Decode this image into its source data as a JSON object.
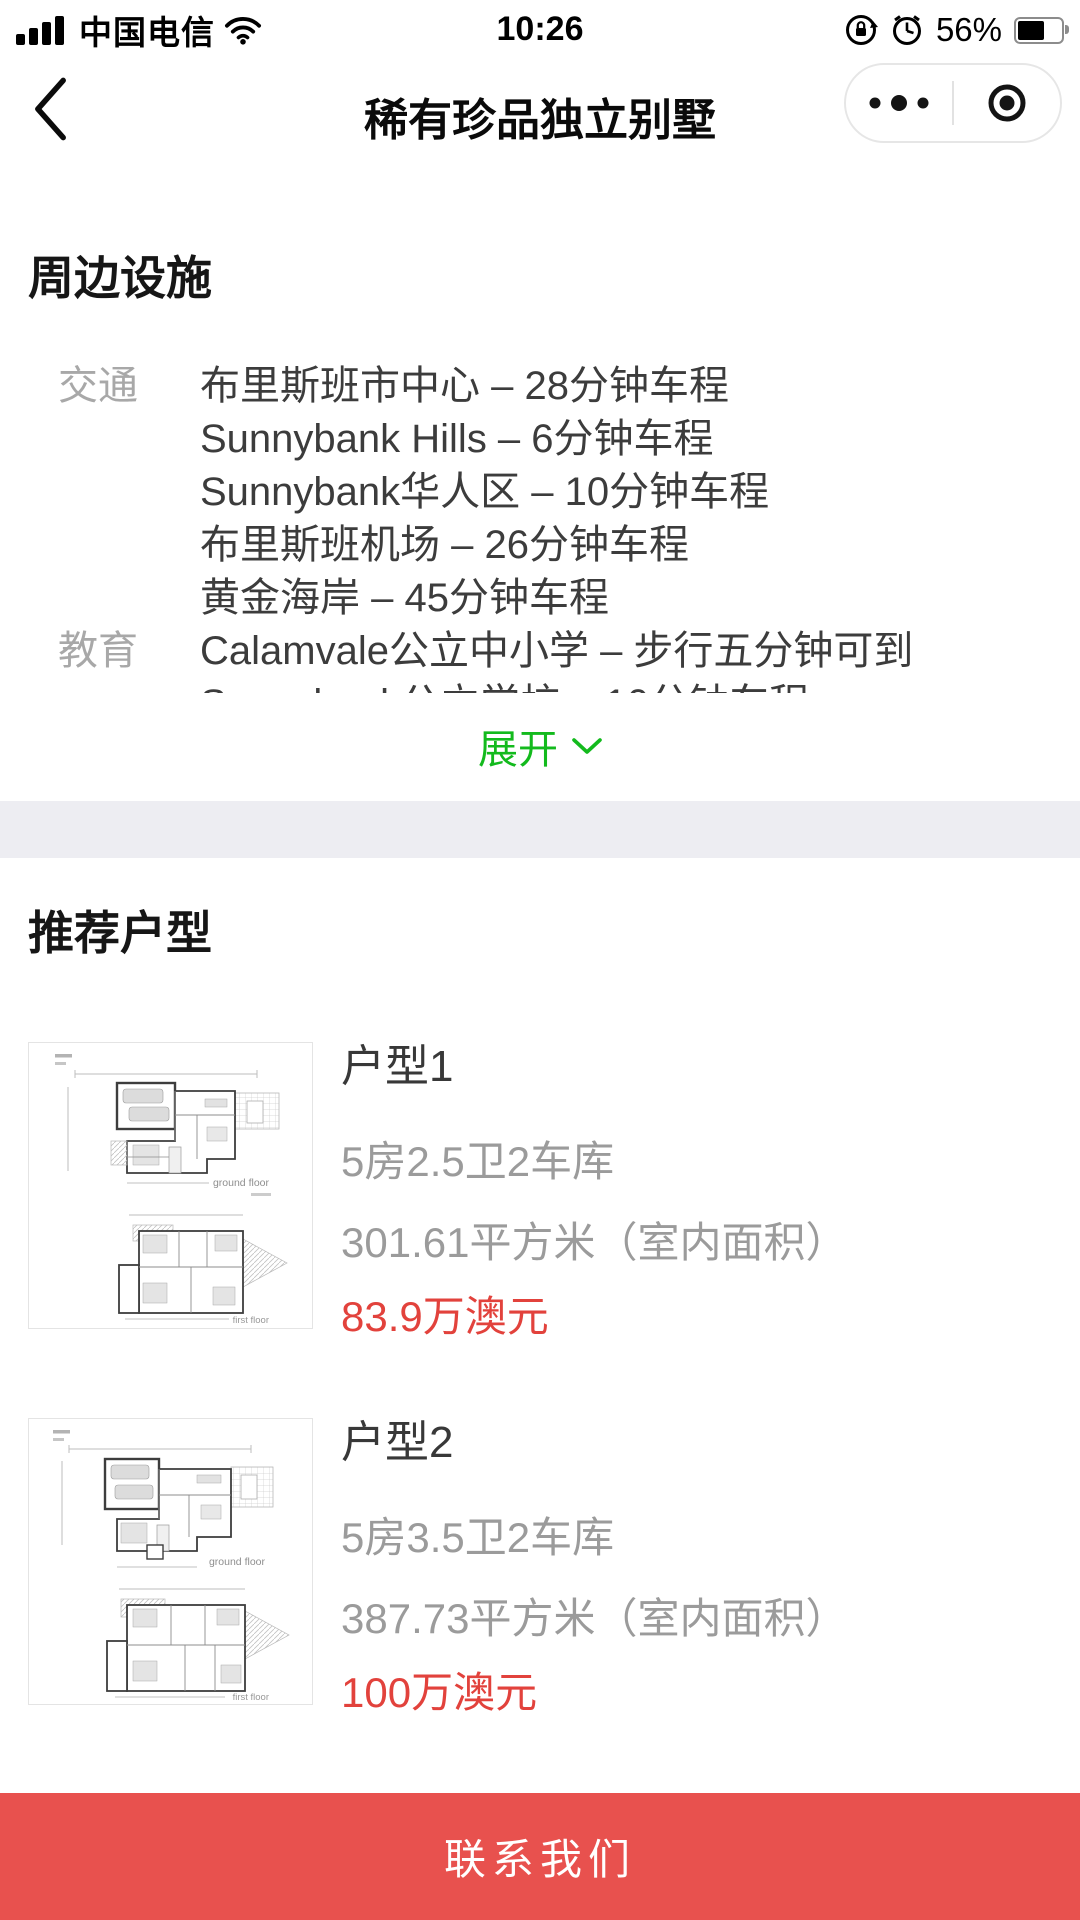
{
  "status_bar": {
    "carrier": "中国电信",
    "time": "10:26",
    "battery_percent": "56%"
  },
  "nav": {
    "title": "稀有珍品独立别墅"
  },
  "facilities": {
    "heading": "周边设施",
    "groups": [
      {
        "label": "交通",
        "lines": [
          "布里斯班市中心 – 28分钟车程",
          "Sunnybank Hills – 6分钟车程",
          "Sunnybank华人区 – 10分钟车程",
          "布里斯班机场 – 26分钟车程",
          "黄金海岸 – 45分钟车程"
        ]
      },
      {
        "label": "教育",
        "lines": [
          "Calamvale公立中小学 – 步行五分钟可到",
          "Sunnybank公立学校 – 10分钟车程"
        ]
      }
    ],
    "expand_label": "展开"
  },
  "plans": {
    "heading": "推荐户型",
    "items": [
      {
        "title": "户型1",
        "spec": "5房2.5卫2车库",
        "area": "301.61平方米（室内面积）",
        "price": "83.9万澳元",
        "captions": [
          "ground floor",
          "first floor"
        ]
      },
      {
        "title": "户型2",
        "spec": "5房3.5卫2车库",
        "area": "387.73平方米（室内面积）",
        "price": "100万澳元",
        "captions": [
          "ground floor",
          "first floor"
        ]
      }
    ]
  },
  "contact": {
    "label": "联系我们"
  },
  "colors": {
    "wechat_green": "#13ba1d",
    "price_red": "#e2423c",
    "button_red": "#e8514e",
    "band_gray": "#ededf2"
  }
}
